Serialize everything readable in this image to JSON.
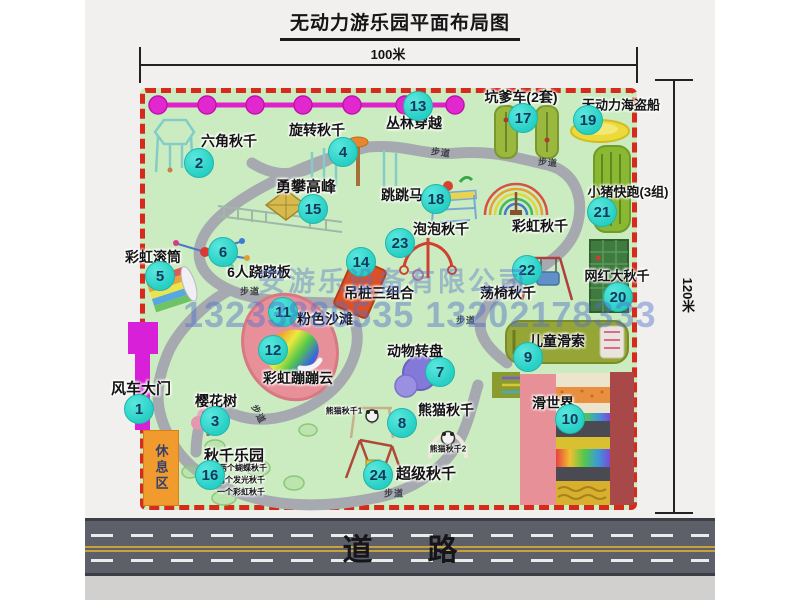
{
  "title": "无动力游乐园平面布局图",
  "dimensions": {
    "width_label": "100米",
    "height_label": "120米"
  },
  "road": {
    "label": "道路"
  },
  "watermark": {
    "company": "安游乐设备有限公司",
    "phone": "13233880535 13202178333"
  },
  "map": {
    "rest_area_label": "休息区",
    "path_label_text": "步道",
    "items": [
      {
        "num": "1",
        "name": "风车大门",
        "bx": 139,
        "by": 409,
        "lx": 141,
        "ly": 388,
        "fs": 15
      },
      {
        "num": "2",
        "name": "六角秋千",
        "bx": 199,
        "by": 163,
        "lx": 229,
        "ly": 141,
        "fs": 14
      },
      {
        "num": "3",
        "name": "樱花树",
        "bx": 215,
        "by": 421,
        "lx": 216,
        "ly": 401,
        "fs": 14
      },
      {
        "num": "4",
        "name": "旋转秋千",
        "bx": 343,
        "by": 152,
        "lx": 317,
        "ly": 130,
        "fs": 14
      },
      {
        "num": "5",
        "name": "彩虹滚筒",
        "bx": 160,
        "by": 276,
        "lx": 153,
        "ly": 257,
        "fs": 14
      },
      {
        "num": "6",
        "name": "6人跷跷板",
        "bx": 223,
        "by": 252,
        "lx": 259,
        "ly": 272,
        "fs": 14
      },
      {
        "num": "7",
        "name": "动物转盘",
        "bx": 440,
        "by": 372,
        "lx": 415,
        "ly": 351,
        "fs": 14
      },
      {
        "num": "8",
        "name": "熊猫秋千",
        "bx": 402,
        "by": 423,
        "lx": 446,
        "ly": 410,
        "fs": 14
      },
      {
        "num": "9",
        "name": "儿童滑索",
        "bx": 528,
        "by": 357,
        "lx": 557,
        "ly": 341,
        "fs": 14
      },
      {
        "num": "10",
        "name": "滑世界",
        "bx": 570,
        "by": 419,
        "lx": 553,
        "ly": 403,
        "fs": 14
      },
      {
        "num": "11",
        "name": "粉色沙滩",
        "bx": 283,
        "by": 312,
        "lx": 325,
        "ly": 319,
        "fs": 14
      },
      {
        "num": "12",
        "name": "彩虹蹦蹦云",
        "bx": 273,
        "by": 350,
        "lx": 298,
        "ly": 378,
        "fs": 14
      },
      {
        "num": "13",
        "name": "丛林穿越",
        "bx": 418,
        "by": 106,
        "lx": 414,
        "ly": 123,
        "fs": 14
      },
      {
        "num": "14",
        "name": "吊桩三组合",
        "bx": 361,
        "by": 262,
        "lx": 379,
        "ly": 293,
        "fs": 14
      },
      {
        "num": "15",
        "name": "勇攀高峰",
        "bx": 313,
        "by": 209,
        "lx": 306,
        "ly": 186,
        "fs": 15
      },
      {
        "num": "16",
        "name": "秋千乐园",
        "bx": 210,
        "by": 475,
        "lx": 234,
        "ly": 455,
        "fs": 15
      },
      {
        "num": "17",
        "name": "坑爹车(2套)",
        "bx": 523,
        "by": 118,
        "lx": 521,
        "ly": 97,
        "fs": 14
      },
      {
        "num": "18",
        "name": "跳跳马",
        "bx": 436,
        "by": 199,
        "lx": 402,
        "ly": 195,
        "fs": 14
      },
      {
        "num": "19",
        "name": "无动力海盗船",
        "bx": 588,
        "by": 120,
        "lx": 621,
        "ly": 104,
        "fs": 13
      },
      {
        "num": "20",
        "name": "网红大秋千",
        "bx": 618,
        "by": 297,
        "lx": 617,
        "ly": 275,
        "fs": 13
      },
      {
        "num": "21",
        "name": "小猪快跑(3组)",
        "bx": 602,
        "by": 212,
        "lx": 628,
        "ly": 191,
        "fs": 13
      },
      {
        "num": "22",
        "name": "荡椅秋千",
        "bx": 527,
        "by": 270,
        "lx": 508,
        "ly": 293,
        "fs": 14
      },
      {
        "num": "23",
        "name": "泡泡秋千",
        "bx": 400,
        "by": 243,
        "lx": 441,
        "ly": 229,
        "fs": 14
      },
      {
        "num": "24",
        "name": "超级秋千",
        "bx": 378,
        "by": 475,
        "lx": 426,
        "ly": 473,
        "fs": 15
      }
    ],
    "extra_labels": [
      {
        "text": "彩虹秋千",
        "x": 540,
        "y": 226,
        "fs": 14,
        "bold": true
      },
      {
        "text": "熊猫秋千1",
        "x": 344,
        "y": 411,
        "fs": 8,
        "bold": false
      },
      {
        "text": "熊猫秋千2",
        "x": 448,
        "y": 449,
        "fs": 8,
        "bold": false
      },
      {
        "text": "两个蝴蝶秋千",
        "x": 243,
        "y": 468,
        "fs": 8,
        "bold": false
      },
      {
        "text": "两个发光秋千",
        "x": 241,
        "y": 480,
        "fs": 8,
        "bold": false
      },
      {
        "text": "一个彩虹秋千",
        "x": 241,
        "y": 492,
        "fs": 8,
        "bold": false
      }
    ],
    "path_labels": [
      {
        "x": 250,
        "y": 291,
        "rot": 0
      },
      {
        "x": 441,
        "y": 152,
        "rot": 8
      },
      {
        "x": 548,
        "y": 162,
        "rot": 5
      },
      {
        "x": 466,
        "y": 320,
        "rot": 0
      },
      {
        "x": 259,
        "y": 414,
        "rot": 62
      },
      {
        "x": 394,
        "y": 493,
        "rot": 0
      }
    ]
  }
}
